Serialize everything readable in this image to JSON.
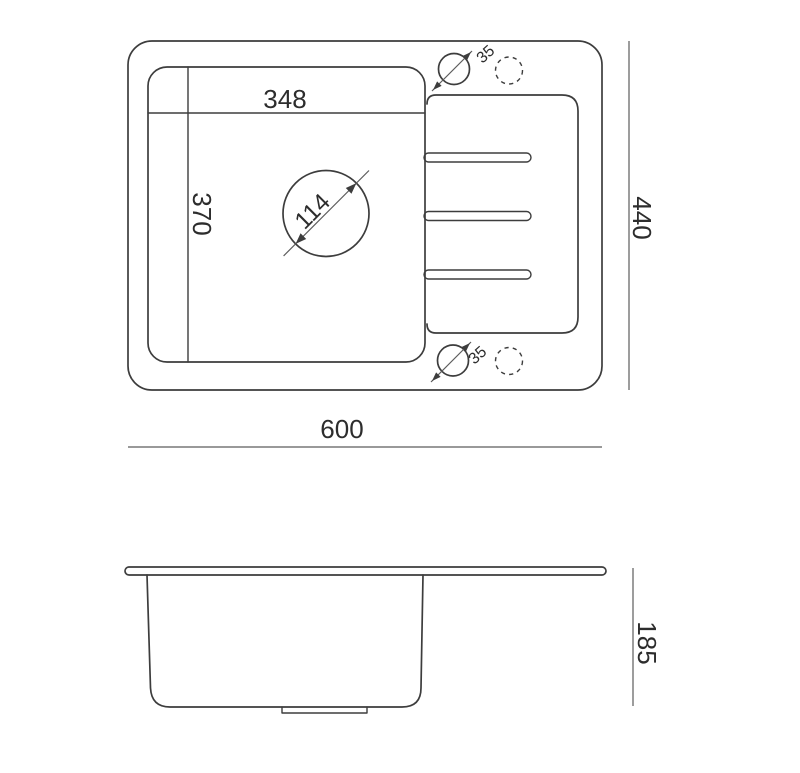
{
  "palette": {
    "background": "#ffffff",
    "outline_color": "#3d3d3d",
    "dimension_line_color": "#5c5c5c",
    "text_color": "#2d2d2d"
  },
  "top_view": {
    "labels": {
      "bowl_width": "348",
      "bowl_depth": "370",
      "drain_diameter": "114",
      "tap_hole_diameter_top": "35",
      "tap_hole_diameter_bottom": "35",
      "overall_width": "600",
      "overall_depth": "440"
    }
  },
  "side_view": {
    "labels": {
      "height": "185"
    }
  }
}
